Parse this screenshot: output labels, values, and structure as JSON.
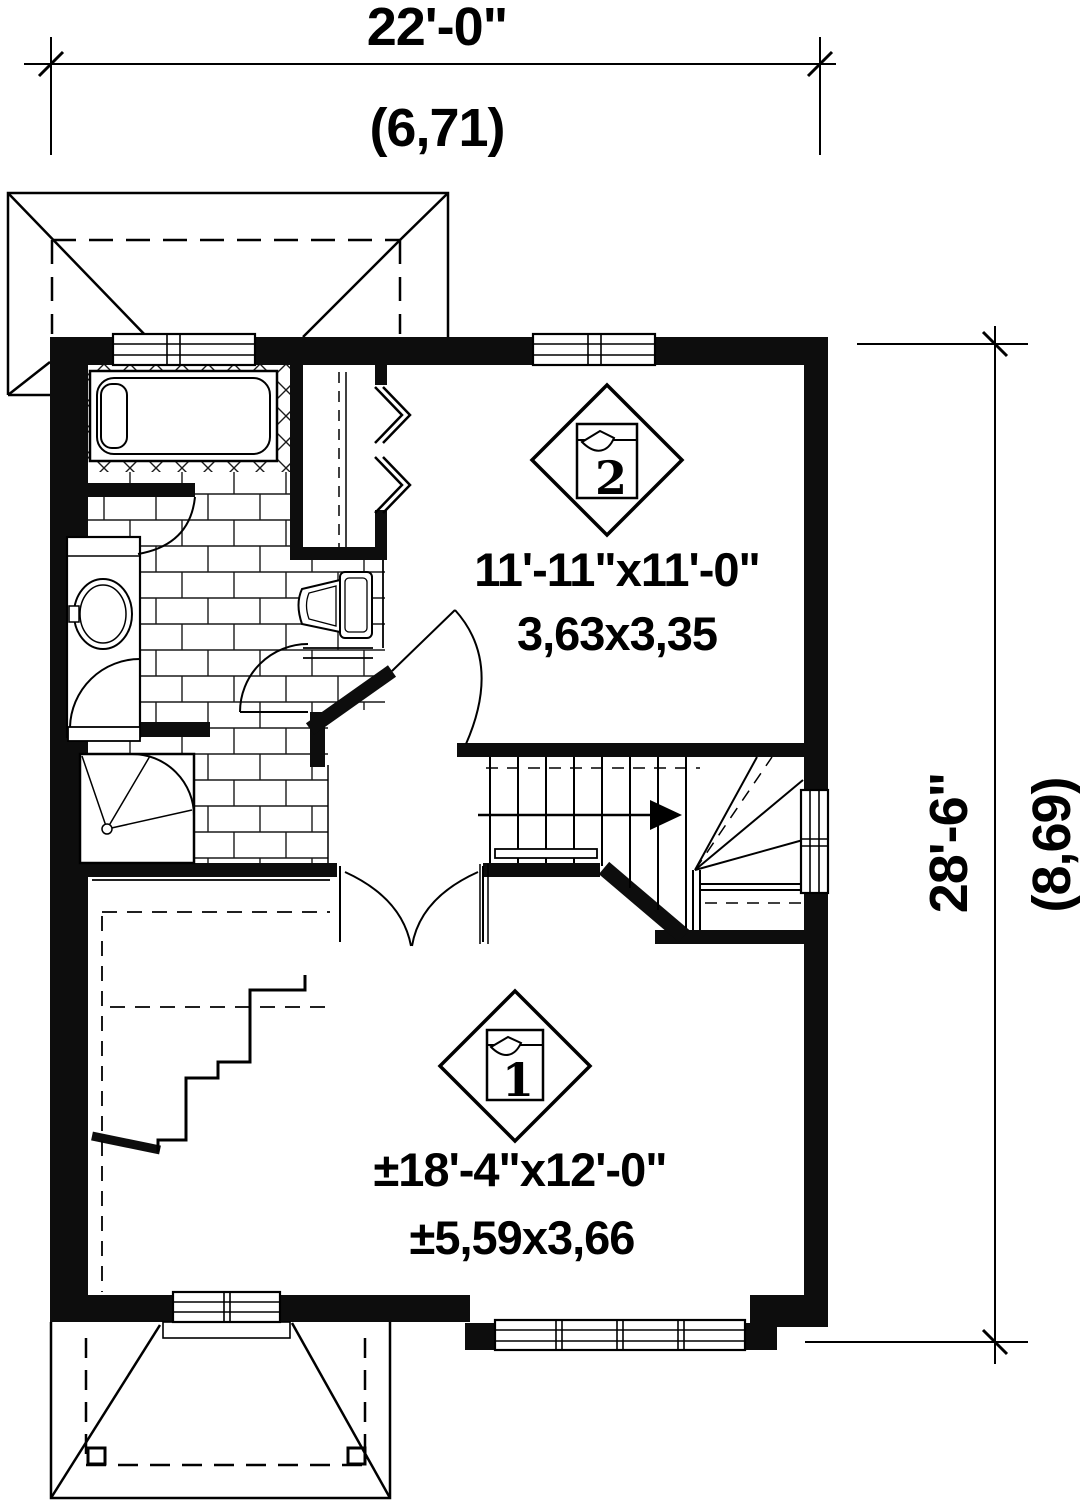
{
  "drawing": {
    "kind": "second-floor plan",
    "background": "#ffffff",
    "line_color": "#000000",
    "wall_color": "#0d0d0d"
  },
  "dimensions": {
    "top": {
      "imperial": "22'-0\"",
      "metric": "(6,71)"
    },
    "right": {
      "imperial": "28'-6\"",
      "metric": "(8,69)"
    }
  },
  "rooms": [
    {
      "marker": "1",
      "size_imperial": "±18'-4\"x12'-0\"",
      "size_metric": "±5,59x3,66"
    },
    {
      "marker": "2",
      "size_imperial": "11'-11\"x11'-0\"",
      "size_metric": "3,63x3,35"
    }
  ],
  "icons": {
    "stair_direction_arrow": "arrow-right",
    "room_marker_shape": "diamond-with-page-curl"
  }
}
